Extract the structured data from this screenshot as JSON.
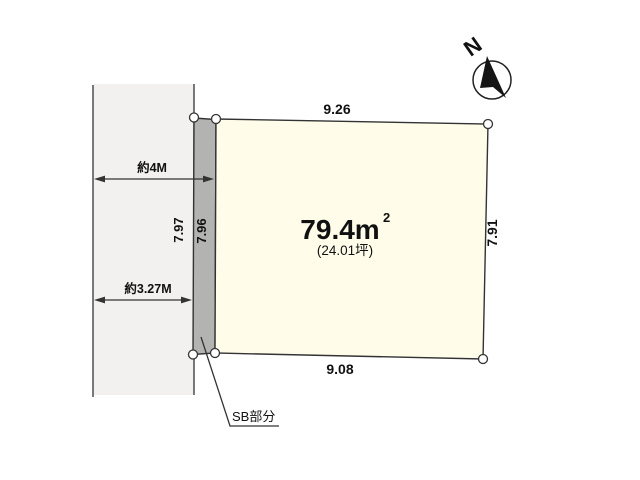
{
  "diagram": {
    "compass_label": "N",
    "dim_top": "9.26",
    "dim_bottom": "9.08",
    "dim_right": "7.91",
    "dim_setback_outer": "7.97",
    "dim_setback_inner": "7.96",
    "road_width_total": "約4M",
    "road_width_current": "約3.27M",
    "area_value": "79.4m",
    "area_sup": "2",
    "area_tsubo": "(24.01坪)",
    "setback_label": "SB部分"
  },
  "colors": {
    "road_fill": "#f2f1ef",
    "setback_fill": "#b3b3b1",
    "plot_fill": "#fffdea",
    "line": "#333333",
    "text": "#111111"
  }
}
